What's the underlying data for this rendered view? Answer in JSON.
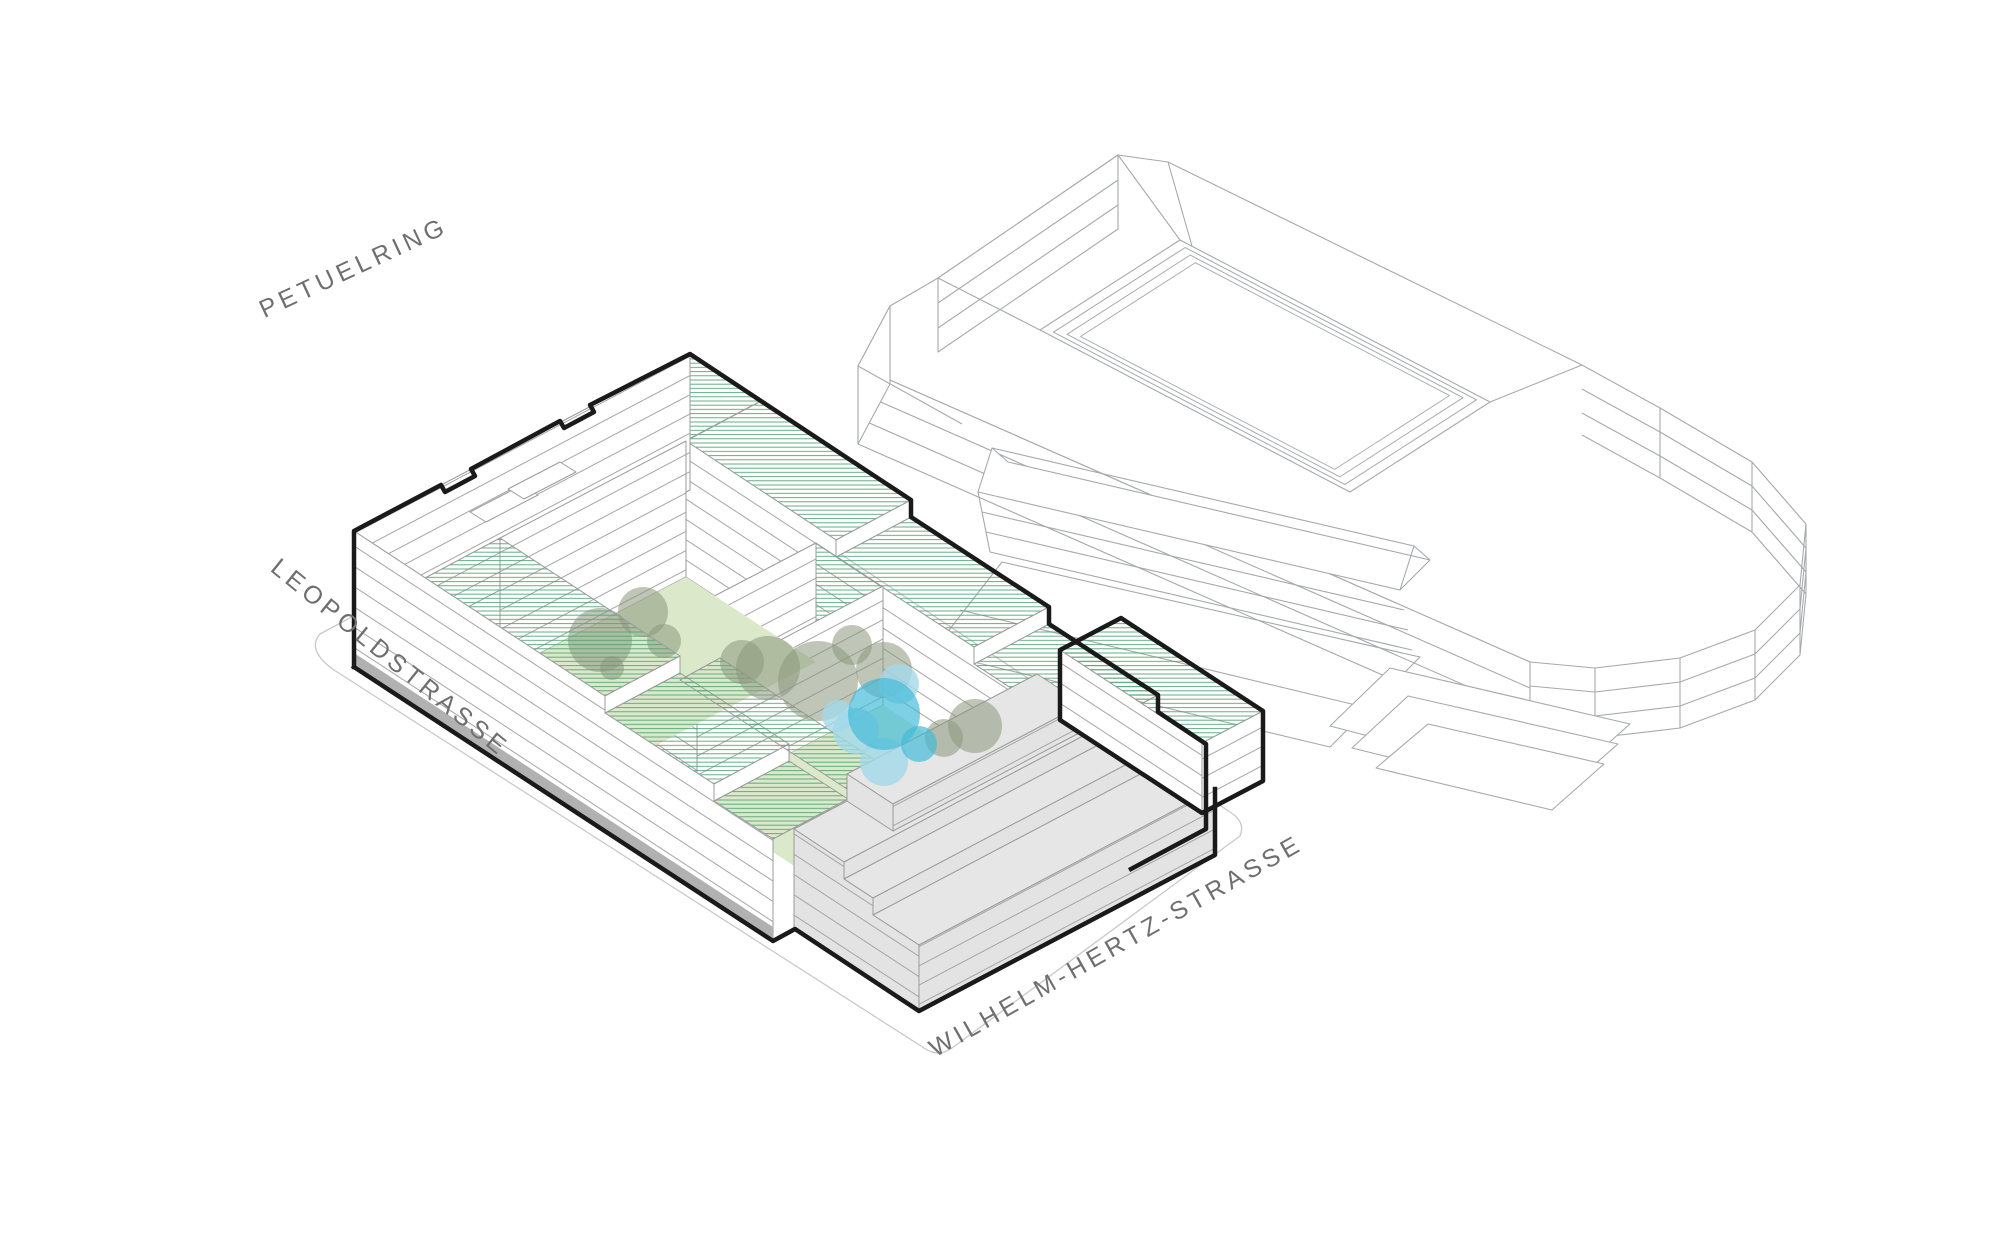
{
  "page": {
    "background": "#ffffff",
    "description_labels_count": 3
  },
  "labels": {
    "street_top": "PETUELRING",
    "street_left": "LEOPOLDSTRASSE",
    "street_bottom": "WILHELM-HERTZ-STRASSE"
  },
  "colors": {
    "roof_hatch_green": "#55a377",
    "courtyard_green": "#dce8ca",
    "tree_olive": "#8a987c",
    "water_blue": "#41b9d9",
    "water_light_blue": "#a3d8e8",
    "building_gray": "#e3e3e3",
    "flat_roof_gray": "#e6e6e6",
    "edge_line_gray": "#9b9b9b",
    "floor_line_gray": "#a5a5a5",
    "outline_black": "#1a1a1a",
    "base_band_gray": "#b1b1b1",
    "wireframe_gray": "#a6a9ac",
    "ground_line_gray": "#c9c9c9",
    "label_gray": "#6f6f6f"
  }
}
